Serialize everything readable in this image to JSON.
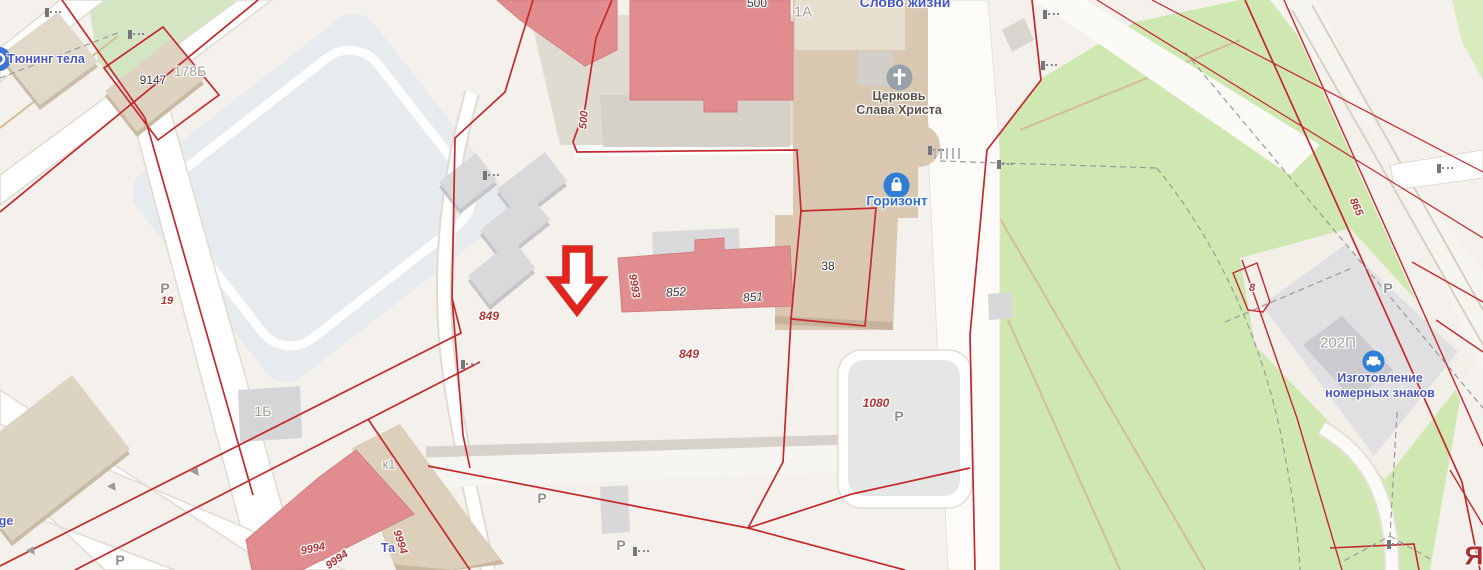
{
  "map": {
    "poi_labels": {
      "tuning_tela": "Тюнинг тела",
      "slovo_zhizni": "Слово жизни",
      "church_line1": "Церковь",
      "church_line2": "Слава Христа",
      "gorizont": "Горизонт",
      "plates_line1": "Изготовление",
      "plates_line2": "номерных знаков",
      "ge_partial": "ge",
      "ta_partial": "Та"
    },
    "building_labels": {
      "b9147": "9147",
      "b500": "500",
      "b38": "38",
      "b852": "852",
      "b851": "851",
      "b178b": "178Б",
      "b1a": "1А",
      "b1b": "1Б",
      "bk1": "к1",
      "b202p": "202П"
    },
    "parcel_labels": {
      "p849_west": "849",
      "p849_east": "849",
      "p9993": "9993",
      "p500": "500",
      "p1080": "1080",
      "p19": "19",
      "p8": "8",
      "p865": "865",
      "p9994_a": "9994",
      "p9994_b": "9994",
      "p9994_c": "9994",
      "street_ya": "Я"
    },
    "parking_letter": "Р",
    "colors": {
      "cadastral_line": "#c5282d",
      "building_pink": "#e18d90",
      "building_tan": "#d9c7b2",
      "building_gray": "#d9d9dc",
      "greenery": "#cfe7b0",
      "poi_blue": "#4a58c4",
      "parcel_red": "#b23434",
      "arrow_red": "#e0241e"
    }
  }
}
